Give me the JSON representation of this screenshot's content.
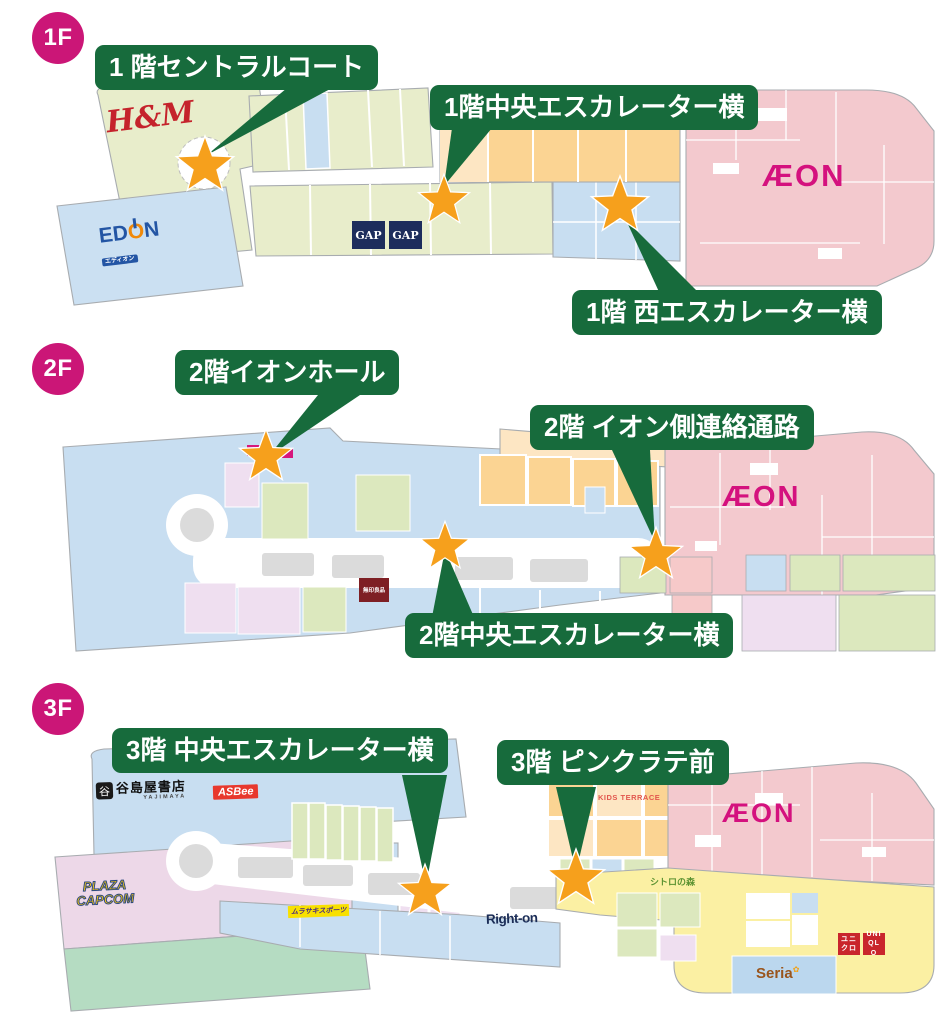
{
  "colors": {
    "badge_pink": "#CB1677",
    "callout_green": "#176B3C",
    "star_orange": "#F6A01C",
    "aeon_magenta": "#D4117E",
    "map_green": "#E8EDCB",
    "map_blue": "#C8DEF1",
    "map_pink": "#F3C9CE",
    "map_orange": "#FBD493",
    "map_yellow": "#FBF0A3"
  },
  "floors": [
    {
      "badge": "1F",
      "callouts": [
        {
          "text": "1 階セントラルコート"
        },
        {
          "text": "1階中央エスカレーター横"
        },
        {
          "text": "1階 西エスカレーター横"
        }
      ],
      "stores": {
        "hm": "H&M",
        "edion": {
          "p1": "ED",
          "p2": "O",
          "p3": "N",
          "sub": "エディオン"
        },
        "gap1": "GAP",
        "gap2": "GAP",
        "aeon": "ÆON"
      }
    },
    {
      "badge": "2F",
      "callouts": [
        {
          "text": "2階イオンホール"
        },
        {
          "text": "2階 イオン側連絡通路"
        },
        {
          "text": "2階中央エスカレーター横"
        }
      ],
      "stores": {
        "muji": "無印良品",
        "aeon": "ÆON"
      }
    },
    {
      "badge": "3F",
      "callouts": [
        {
          "text": "3階 中央エスカレーター横"
        },
        {
          "text": "3階 ピンクラテ前"
        }
      ],
      "stores": {
        "yajimaya_mark": "谷",
        "yajimaya": "谷島屋書店",
        "yajimaya_sub": "YAJIMAYA",
        "asbee": "ASBee",
        "plaza_line1": "PLAZA",
        "plaza_line2": "CAPCOM",
        "murasaki": "ムラサキスポーツ",
        "righton": "Right-on",
        "kids": "KIDS TERRACE",
        "shitoro": "シトロの森",
        "seria": "Seria",
        "seria_accent": "✿",
        "uniqlo_jp": "ユニクロ",
        "uniqlo_en": "UNIQLO",
        "aeon": "ÆON"
      }
    }
  ]
}
